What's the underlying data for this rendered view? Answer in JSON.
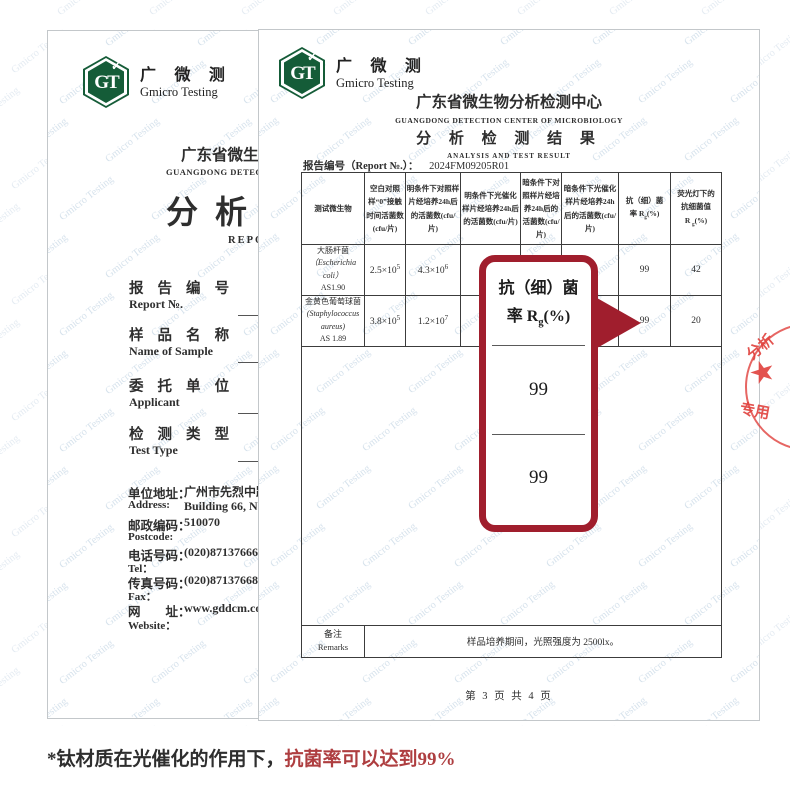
{
  "watermark": {
    "text": "Gmicro Testing"
  },
  "brand": {
    "monogram": "GT",
    "check": "✓",
    "cn": "广 微 测",
    "en": "Gmicro Testing"
  },
  "left_page": {
    "org_cn": "广东省微生物分析检测中心",
    "org_en": "GUANGDONG DETECTION CENTER OF MICROBIOLOGY",
    "title_cn": "分析检测",
    "title_en": "REPORT",
    "fields": [
      {
        "cn": "报 告 编 号",
        "en": "Report №."
      },
      {
        "cn": "样 品 名 称",
        "en": "Name of Sample"
      },
      {
        "cn": "委 托 单 位",
        "en": "Applicant"
      },
      {
        "cn": "检 测 类 型",
        "en": "Test Type"
      }
    ],
    "contact": {
      "addr_cn": "单位地址：",
      "addr_val_cn": "广州市先烈中路",
      "addr_en": "Address:",
      "addr_val_en": "Building 66, No. 1",
      "post_cn": "邮政编码：",
      "post_val": "510070",
      "post_en": "Postcode:",
      "tel_cn": "电话号码：",
      "tel_val": "(020)87137666",
      "tel_en": "Tel：",
      "fax_cn": "传真号码：",
      "fax_val": "(020)87137668",
      "fax_en": "Fax：",
      "web_cn": "网　　址：",
      "web_val": "www.gddcm.com",
      "web_en": "Website："
    }
  },
  "right_page": {
    "org_cn": "广东省微生物分析检测中心",
    "org_en": "GUANGDONG  DETECTION  CENTER  OF  MICROBIOLOGY",
    "title_cn": "分 析 检 测 结 果",
    "title_en": "ANALYSIS AND TEST RESULT",
    "report_no_label": "报告编号（Report №.）：",
    "report_no": "2024FM09205R01",
    "table": {
      "col_headers": {
        "c1": "测试微生物",
        "c2": "空白对照样“0”接触时间活菌数(cfu/片)",
        "c3": "明条件下对照样片经培养24h后的活菌数(cfu/片)",
        "c4": "明条件下光催化样片经培养24h后的活菌数(cfu/片)",
        "c5": "暗条件下对照样片经培养24h后的活菌数(cfu/片)",
        "c6": "暗条件下光催化样片经培养24h后的活菌数(cfu/片)",
        "c7": {
          "l1": "抗（细）菌",
          "pre": "率 R",
          "sub": "g",
          "post": "(%)"
        },
        "c8": {
          "l1": "荧光灯下的",
          "l2": "抗细菌值",
          "pre": "R ",
          "sub": "g",
          "post": "(%)"
        }
      },
      "rows": [
        {
          "name_cn": "大肠杆菌",
          "name_la": "（Escherichia coli）",
          "strain": "AS1.90",
          "blank": {
            "base": "2.5×10",
            "exp": "5"
          },
          "light_ctrl": {
            "base": "4.3×10",
            "exp": "6"
          },
          "light_photo_fragment": "2.",
          "dark_photo_fragment": {
            "base": "0",
            "exp": "4"
          },
          "rate": "99",
          "fluor": "42"
        },
        {
          "name_cn": "金黄色葡萄球菌",
          "name_la": "(Staphylococcus aureus)",
          "strain": "AS 1.89",
          "blank": {
            "base": "3.8×10",
            "exp": "5"
          },
          "light_ctrl": {
            "base": "1.2×10",
            "exp": "7"
          },
          "light_photo_fragment": "6.",
          "rate": "99",
          "fluor": "20"
        }
      ],
      "remarks_label_cn": "备注",
      "remarks_label_en": "Remarks",
      "remarks_text": "样品培养期间，光照强度为 2500lx。"
    },
    "footer": "第 3 页 共 4 页",
    "stamp": {
      "arc_top": "分析",
      "arc_bottom": "专用",
      "star": "★"
    }
  },
  "callout": {
    "title_l1": "抗（细）菌",
    "title_pre": "率 R",
    "title_sub": "g",
    "title_post": "(%)",
    "value1": "99",
    "value2": "99"
  },
  "caption": {
    "prefix": "*钛材质在光催化的作用下，",
    "highlight": "抗菌率可以达到99%"
  },
  "colors": {
    "logo_green": "#155c38",
    "callout_red": "#a01e2d",
    "caption_red": "#ae3e40",
    "stamp_red": "#e0403c"
  }
}
